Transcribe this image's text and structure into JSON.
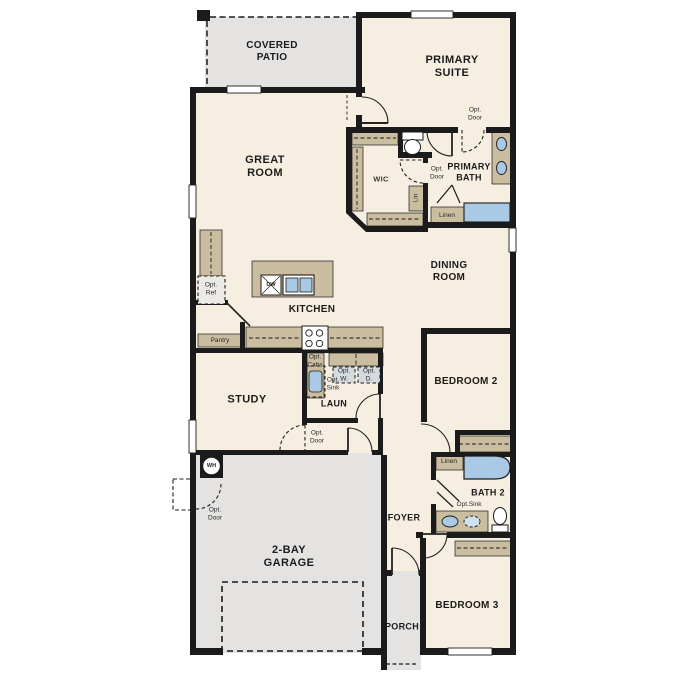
{
  "labels": {
    "covered_patio": "COVERED\nPATIO",
    "primary_suite": "PRIMARY\nSUITE",
    "great_room": "GREAT\nROOM",
    "wic": "WIC",
    "primary_bath": "PRIMARY\nBATH",
    "opt_door": "Opt.\nDoor",
    "lin": "Lin",
    "linen": "Linen",
    "dining_room": "DINING\nROOM",
    "kitchen": "KITCHEN",
    "opt_ref": "Opt.\nRef",
    "pantry": "Pantry",
    "dw": "DW",
    "opt_cabs": "Opt.\nCabs",
    "opt_sink_stacked": "Opt.\nSink",
    "opt_w": "Opt.\nW.",
    "opt_d": "Opt.\nD.",
    "laun": "LAUN",
    "study": "STUDY",
    "bedroom_2": "BEDROOM 2",
    "bath_2": "BATH 2",
    "opt_sink_inline": "Opt.Sink",
    "foyer": "FOYER",
    "wh": "WH",
    "garage": "2-BAY\nGARAGE",
    "porch": "PORCH",
    "bedroom_3": "BEDROOM 3"
  },
  "colors": {
    "wall": "#1b1b1b",
    "floor": "#f6efe1",
    "outdoor_concrete": "#e4e3e1",
    "cabinetry_tan": "#cbbd9f",
    "fixture_blue": "#a9c9e4",
    "fixture_light_blue": "#cfe0ee",
    "background": "#ffffff"
  },
  "icons": {
    "toilet-icon": "tank + oval bowl shape",
    "sink-icon": "blue oval basin",
    "bathtub-icon": "blue rounded rectangle",
    "shower-icon": "blue rectangle",
    "stove-icon": "white box with 4 burner circles",
    "dishwasher-icon": "box with diagonals labeled DW",
    "water-heater-icon": "circle labeled WH",
    "door-swing-icon": "quarter-circle arc",
    "optional-item-icon": "dashed outline box"
  }
}
